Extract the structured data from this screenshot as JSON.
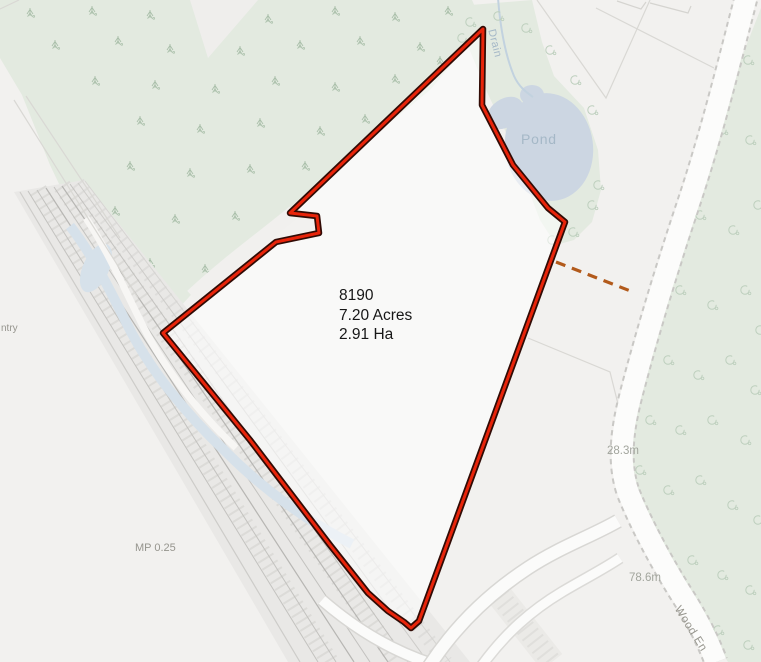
{
  "map": {
    "parcel": {
      "id": "8190",
      "area_acres": "7.20 Acres",
      "area_hectares": "2.91 Ha"
    },
    "water": {
      "pond_label": "Pond",
      "drain_label": "Drain"
    },
    "roads": {
      "road_name_partial": "Wood En"
    },
    "railway": {
      "milepost": "MP 0.25",
      "partial_label": "ntry"
    },
    "elevations": {
      "spot_height_1": "28.3m",
      "spot_height_2": "78.6m"
    },
    "symbols": {
      "conifer": "conifer-tree-icon",
      "deciduous": "deciduous-tree-icon"
    }
  },
  "colors": {
    "background": "#f2f1ef",
    "woodland": "#e3eae0",
    "woodland_symbol": "#aec4ae",
    "pond": "#ccd6e2",
    "stream": "#d6e1ea",
    "parcel_line": "#e8240a",
    "parcel_casing": "#310b05",
    "connector": "#b25a1b",
    "label_dark": "#171717",
    "label_gray": "#96958e",
    "label_water": "#a5b8c7",
    "label_elevation": "#a2a59d"
  }
}
